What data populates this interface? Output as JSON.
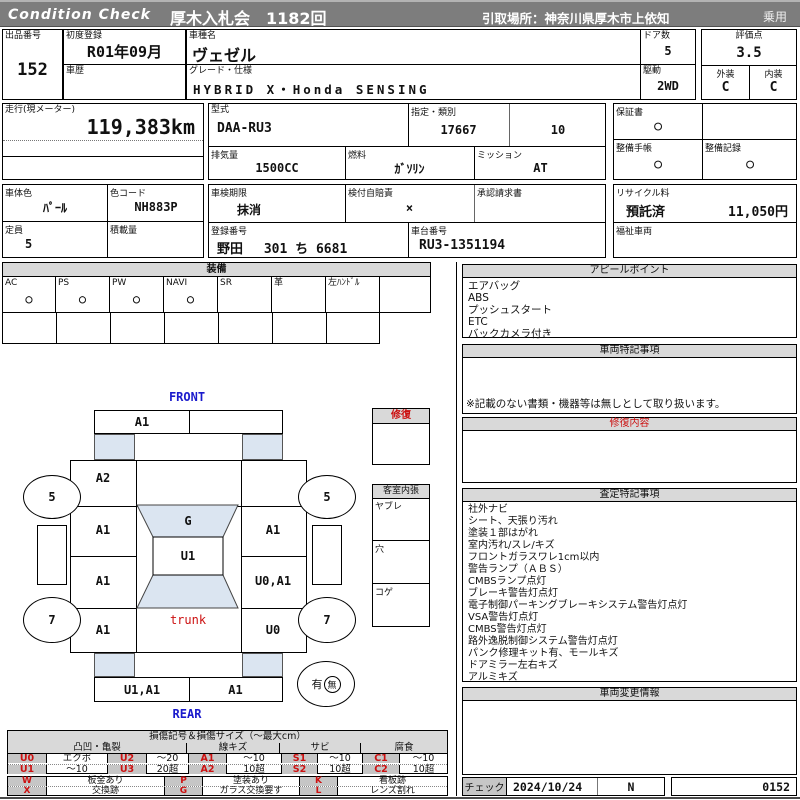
{
  "colors": {
    "header_bar": "#7d7d7d",
    "glass_blue": "#dbe5f1",
    "alert_red": "#cc1111",
    "label_blue": "#1a1acc"
  },
  "header": {
    "brand": "Condition  Check",
    "venue": "厚木入札会　1182回",
    "pickup": "引取場所：神奈川県厚木市上依知",
    "category": "乗用"
  },
  "info": {
    "lot_label": "出品番号",
    "lot": "152",
    "first_reg_label": "初度登録",
    "first_reg": "R01年09月",
    "model_name_label": "車種名",
    "model_name": "ヴェゼル",
    "history_label": "車歴",
    "history": "",
    "grade_label": "グレード・仕様",
    "grade": "HYBRID X・Honda SENSING",
    "doors_label": "ドア数",
    "doors": "5",
    "drive_label": "駆動",
    "drive": "2WD",
    "score_label": "評価点",
    "score": "3.5",
    "exterior_label": "外装",
    "exterior": "C",
    "interior_label": "内装",
    "interior": "C",
    "mileage_label": "走行(現メーター)",
    "mileage": "119,383km",
    "model_code_label": "型式",
    "model_code": "DAA-RU3",
    "class_label": "指定・類別",
    "class1": "17667",
    "class2": "10",
    "warranty_label": "保証書",
    "warranty": "○",
    "displacement_label": "排気量",
    "displacement": "1500CC",
    "fuel_label": "燃料",
    "fuel": "ｶﾞｿﾘﾝ",
    "transmission_label": "ミッション",
    "transmission": "AT",
    "maintenance_book_label": "整備手帳",
    "maintenance_book": "○",
    "maintenance_record_label": "整備記録",
    "maintenance_record": "○",
    "body_color_label": "車体色",
    "body_color": "ﾊﾟｰﾙ",
    "color_code_label": "色コード",
    "color_code": "NH883P",
    "inspection_label": "車検期限",
    "inspection": "抹消",
    "insurance_label": "検付自賠責",
    "insurance": "×",
    "approval_label": "承認請求書",
    "approval": "",
    "recycle_label": "リサイクル料",
    "recycle_status": "預託済",
    "recycle_fee": "11,050円",
    "capacity_label": "定員",
    "capacity": "5",
    "load_label": "積載量",
    "load": "",
    "reg_no_label": "登録番号",
    "reg_no": "野田　 301 ち 6681",
    "chassis_label": "車台番号",
    "chassis": "RU3-1351194",
    "welfare_label": "福祉車両",
    "welfare": ""
  },
  "equipment": {
    "title": "装備",
    "cols": [
      {
        "label": "AC",
        "value": "○"
      },
      {
        "label": "PS",
        "value": "○"
      },
      {
        "label": "PW",
        "value": "○"
      },
      {
        "label": "NAVI",
        "value": "○"
      },
      {
        "label": "SR",
        "value": ""
      },
      {
        "label": "革",
        "value": ""
      },
      {
        "label": "左ﾊﾝﾄﾞﾙ",
        "value": ""
      },
      {
        "label": "",
        "value": ""
      }
    ]
  },
  "appeal": {
    "title": "アピールポイント",
    "items": [
      "エアバッグ",
      "ABS",
      "プッシュスタート",
      "ETC",
      "バックカメラ付き"
    ]
  },
  "vehicle_notes": {
    "title": "車両特記事項",
    "note": "※記載のない書類・機器等は無しとして取り扱います。"
  },
  "repair_detail": {
    "title": "修復内容",
    "body": ""
  },
  "assessment": {
    "title": "査定特記事項",
    "items": [
      "社外ナビ",
      "シート、天張り汚れ",
      "塗装１部はがれ",
      "室内汚れ/スレ/キズ",
      "フロントガラスワレ1cm以内",
      "警告ランプ（ＡＢＳ）",
      "CMBSランプ点灯",
      "ブレーキ警告灯点灯",
      "電子制御パーキングブレーキシステム警告灯点灯",
      "VSA警告灯点灯",
      "CMBS警告灯点灯",
      "路外逸脱制御システム警告灯点灯",
      "パンク修理キット有、モールキズ",
      "ドアミラー左右キズ",
      "アルミキズ"
    ]
  },
  "change_info": {
    "title": "車両変更情報",
    "body": ""
  },
  "check": {
    "label": "チェック",
    "date": "2024/10/24",
    "flag": "N",
    "number": "0152"
  },
  "diagram": {
    "front_label": "FRONT",
    "rear_label": "REAR",
    "front_bumper_left": "A1",
    "front_bumper_right": "",
    "left_fender": "A2",
    "left_door_front": "A1",
    "left_door_rear": "A1",
    "left_quarter": "A1",
    "right_fender": "",
    "right_door_front": "A1",
    "right_door_rear": "U0,A1",
    "right_quarter": "U0",
    "windshield": "G",
    "roof": "U1",
    "trunk": "trunk",
    "rear_bumper_left": "U1,A1",
    "rear_bumper_right": "A1",
    "wheel_front_left": "5",
    "wheel_front_right": "5",
    "wheel_rear_left": "7",
    "wheel_rear_right": "7",
    "spare_yes": "有",
    "spare_no": "無",
    "repair_box_title": "修復",
    "interior_box": {
      "title": "客室内張",
      "rows": [
        "ヤブレ",
        "穴",
        "コゲ"
      ]
    }
  },
  "legend": {
    "title": "損傷記号＆損傷サイズ（～最大cm）",
    "groups": [
      "凸凹・亀裂",
      "線キズ",
      "サビ",
      "腐食"
    ],
    "row1": [
      {
        "code": "U0",
        "desc": "エクボ"
      },
      {
        "code": "U2",
        "desc": "～20"
      },
      {
        "code": "A1",
        "desc": "～10"
      },
      {
        "code": "S1",
        "desc": "～10"
      },
      {
        "code": "C1",
        "desc": "～10"
      }
    ],
    "row2": [
      {
        "code": "U1",
        "desc": "～10"
      },
      {
        "code": "U3",
        "desc": "20超"
      },
      {
        "code": "A2",
        "desc": "10超"
      },
      {
        "code": "S2",
        "desc": "10超"
      },
      {
        "code": "C2",
        "desc": "10超"
      }
    ],
    "row3": [
      {
        "code": "W",
        "desc": "板金あり"
      },
      {
        "code": "P",
        "desc": "塗装あり"
      },
      {
        "code": "K",
        "desc": "看板跡"
      }
    ],
    "row4": [
      {
        "code": "X",
        "desc": "交換跡"
      },
      {
        "code": "G",
        "desc": "ガラス交換要す"
      },
      {
        "code": "L",
        "desc": "レンズ割れ"
      }
    ]
  }
}
